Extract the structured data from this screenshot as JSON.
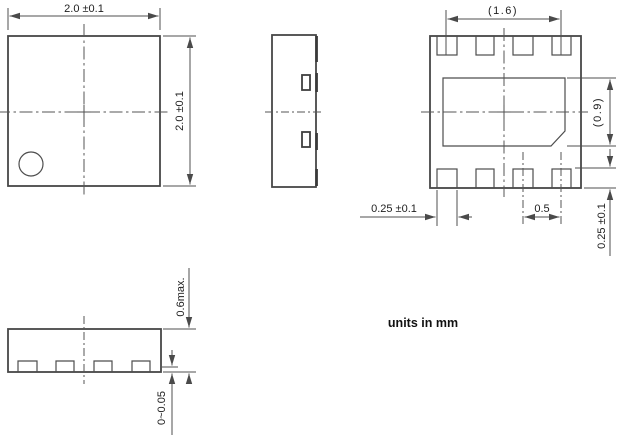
{
  "drawing": {
    "title": "package-outline-drawing",
    "note": "units in mm",
    "colors": {
      "line": "#474747",
      "dim": "#4f4f4f",
      "text": "#1e1e1e"
    },
    "dims": {
      "top_width": "2.0 ±0.1",
      "top_height": "2.0 ±0.1",
      "pad_span": "(1.6)",
      "epad_height": "(0.9)",
      "pad_width": "0.25 ±0.1",
      "pad_pitch": "0.5",
      "pad_length": "0.25 ±0.1",
      "max_height": "0.6max.",
      "standoff": "0~0.05"
    }
  }
}
